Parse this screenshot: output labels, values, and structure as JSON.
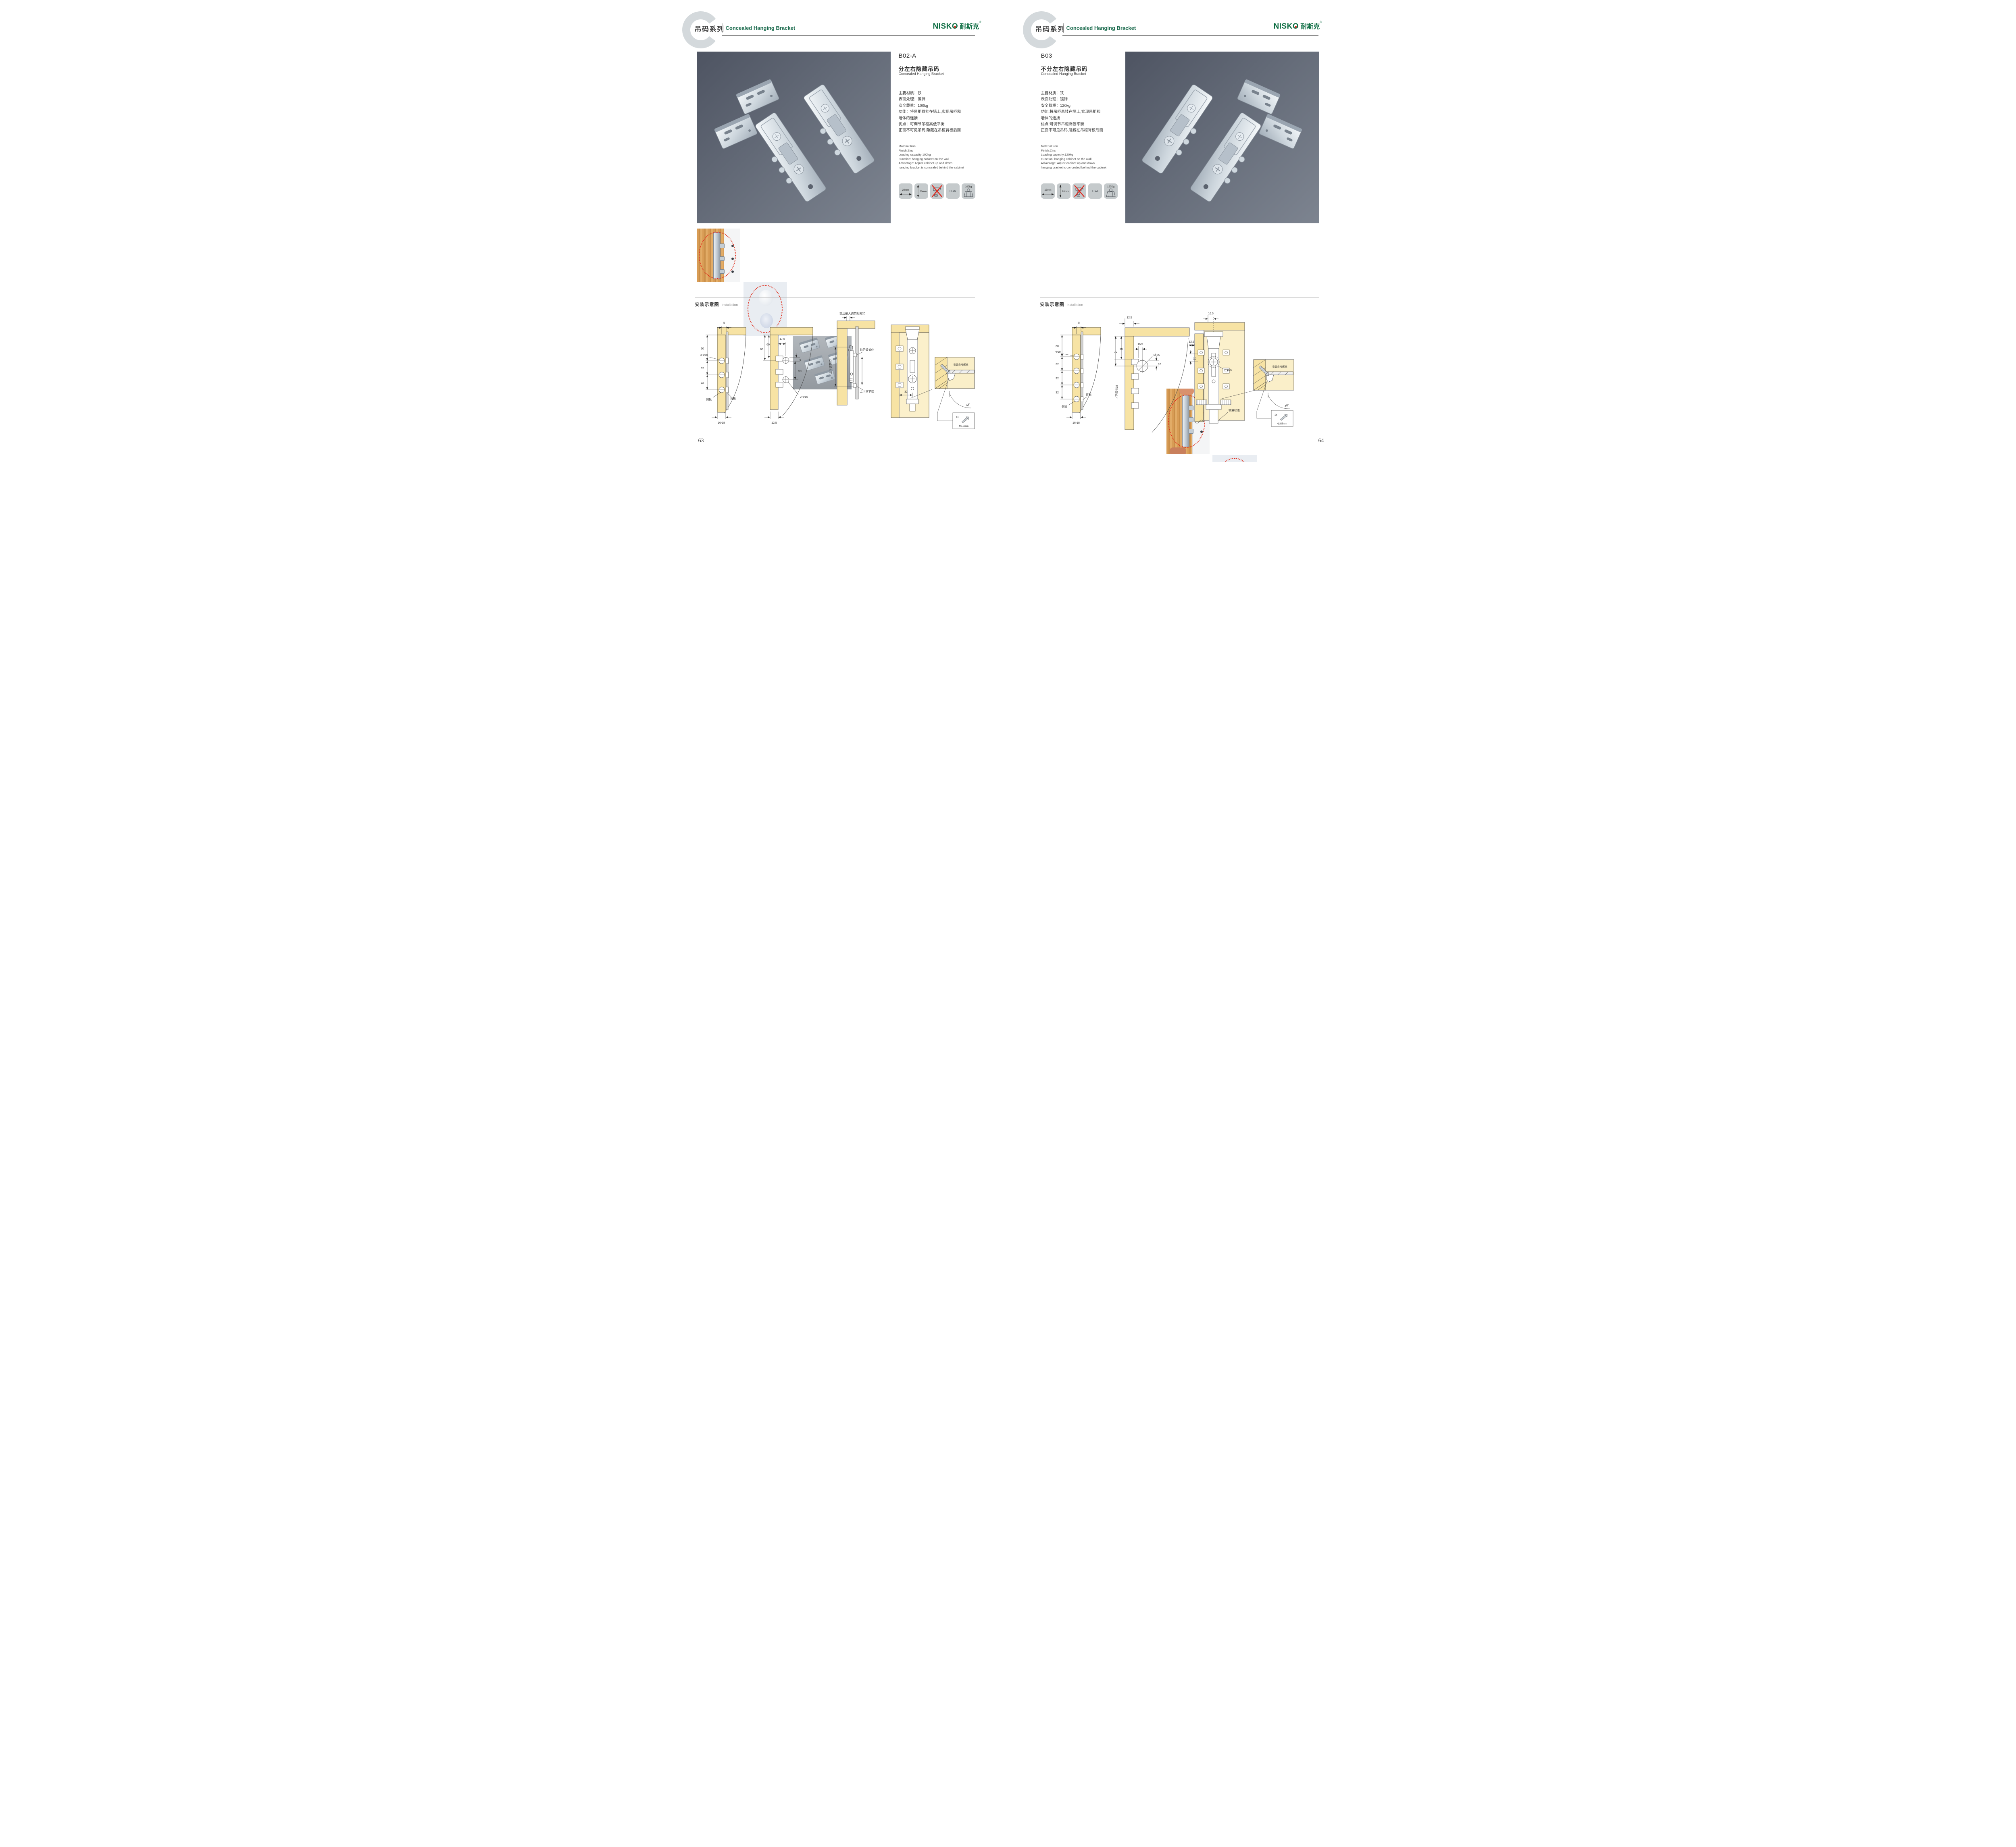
{
  "brand": {
    "name_latin": "NISK",
    "name_o": "O",
    "name_cn": "耐斯克",
    "registered": "®"
  },
  "header": {
    "series_cn": "吊码系列",
    "series_en": "Concealed Hanging Bracket"
  },
  "left_page": {
    "page_number": "63",
    "code": "B02-A",
    "title_cn": "分左右隐藏吊码",
    "title_en": "Concealed Hanging Bracket",
    "specs_cn": [
      "主要材质：铁",
      "表面处理：镀锌",
      "安全载重：100kg",
      "功能：将吊柜悬挂在墙上,实现吊柜和",
      "墙体的连接",
      "优点：可调节吊柜高低平衡",
      "正面不可见吊码,隐藏在吊柜背板后面"
    ],
    "specs_en": [
      "Material:Iron",
      "Finish:Zinc",
      "Loading capacity:100kg",
      "Function: hanging cabinet on the wall",
      "Advantage: Adjust cabinet up and down",
      "hanging bracket is concealed behind the cabinet"
    ],
    "icons": [
      {
        "name": "panel-width",
        "label": "20mm"
      },
      {
        "name": "panel-height",
        "label": "20mm"
      },
      {
        "name": "no-drill",
        "label": ""
      },
      {
        "name": "lga-certified",
        "label": "LGA"
      },
      {
        "name": "load-capacity",
        "label": "100kg"
      }
    ],
    "installation": {
      "title_cn": "安装示意图",
      "title_en": "Installation"
    },
    "diag1": {
      "top": "5",
      "h60": "60",
      "holes": "3-Φ10",
      "s32a": "32",
      "s32b": "32",
      "side": "侧板",
      "back": "背板",
      "bottom": "16-18"
    },
    "diag2": {
      "w175": "17.5",
      "h65": "65",
      "h60": "60",
      "r5": "5",
      "v50": "50",
      "holes": "2-Φ15",
      "b125": "12.5"
    },
    "diag3": {
      "top": "前后最大调节距离20",
      "vert": "上下调节20",
      "fb": "前后调节位",
      "ud": "上下调节位"
    },
    "diag4": {
      "w32": "32"
    },
    "detail": {
      "label": "安装自攻螺丝",
      "angle": "45°",
      "qty": "1x",
      "size": "Φ3.5mm"
    }
  },
  "right_page": {
    "page_number": "64",
    "code": "B03",
    "title_cn": "不分左右隐藏吊码",
    "title_en": "Concealed Hanging Bracket",
    "specs_cn": [
      "主要材质：铁",
      "表面处理：镀锌",
      "安全载重：120kg",
      "功能:将吊柜悬挂在墙上,实现吊柜和",
      "墙体的连接",
      "优点:可调节吊柜高低平衡",
      "正面不可见吊码,隐藏在吊柜背板后面"
    ],
    "specs_en": [
      "Material:Iron",
      "Finish:Zinc",
      "Loading capacity:120kg",
      "Function: hanging cabinet on the wall",
      "Advantage: Adjust cabinet up and down",
      "hanging bracket is concealed behind the cabinet"
    ],
    "icons": [
      {
        "name": "panel-width",
        "label": "15mm"
      },
      {
        "name": "panel-height",
        "label": "18mm"
      },
      {
        "name": "no-drill",
        "label": ""
      },
      {
        "name": "lga-certified",
        "label": "LGA"
      },
      {
        "name": "load-capacity",
        "label": "120Kg"
      }
    ],
    "installation": {
      "title_cn": "安装示意图",
      "title_en": "Installation"
    },
    "diag1": {
      "top": "5",
      "h60": "60",
      "holes": "Φ10",
      "s32a": "32",
      "s32b": "32",
      "s32c": "32",
      "back": "背板",
      "side": "侧板",
      "bottom": "16-18"
    },
    "diag2": {
      "t125": "12.5",
      "h70": "70",
      "h60": "60",
      "w165": "16.5",
      "circle": "Ø 25",
      "off10": "10",
      "vert": "上下调节18"
    },
    "diag3": {
      "t165": "16.5",
      "l125": "12.5",
      "off10": "10",
      "circle": "ø25",
      "lock": "锁紧状态"
    },
    "detail": {
      "label": "安装自攻螺丝",
      "angle": "45°",
      "qty": "1x",
      "size": "Φ3.5mm"
    }
  }
}
